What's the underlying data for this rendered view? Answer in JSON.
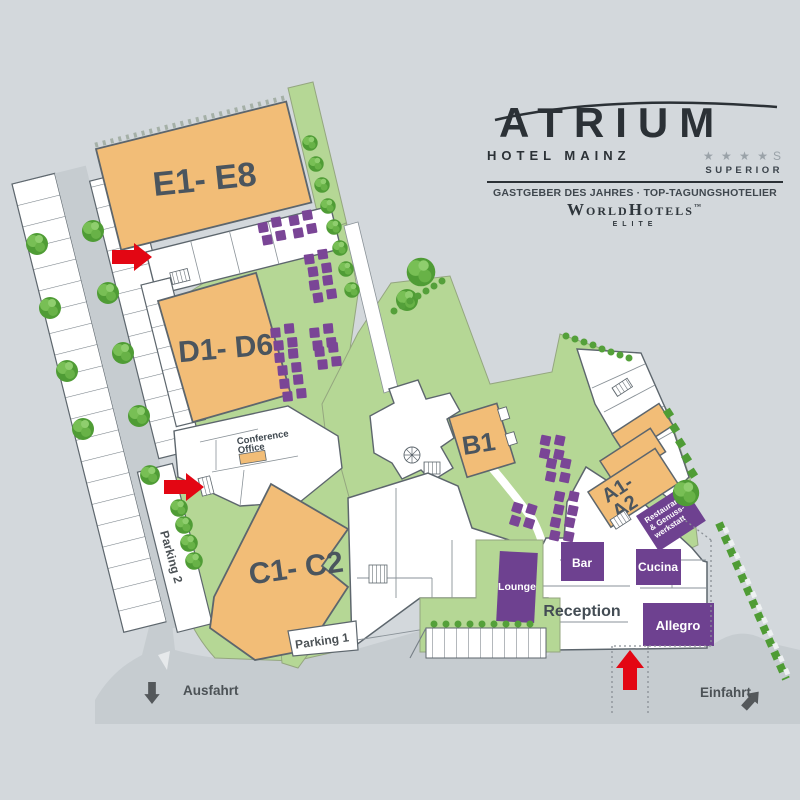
{
  "logo": {
    "brand": "ATRIUM",
    "subbrand": "HOTEL MAINZ",
    "stars": "★ ★ ★ ★",
    "stars_s": "S",
    "superior": "SUPERIOR",
    "award_line": "GASTGEBER DES JAHRES · TOP-TAGUNGSHOTELIER",
    "affiliation": "WorldHotels",
    "affiliation_tm": "™",
    "affiliation_tier": "ELITE"
  },
  "map": {
    "buildings": {
      "e": "E1- E8",
      "d": "D1- D6",
      "c": "C1- C2",
      "b": "B1",
      "a1": "A1-",
      "a2": "A2"
    },
    "venues": {
      "lounge": "Lounge",
      "bar": "Bar",
      "cucina": "Cucina",
      "restaurant1": "Restaurant",
      "restaurant2": "& Genuss-",
      "restaurant3": "werkstatt",
      "reception": "Reception",
      "allegro": "Allegro",
      "conference1": "Conference",
      "conference2": "Office"
    },
    "parking": {
      "p1": "Parking 1",
      "p2": "Parking 2"
    },
    "directions": {
      "exit": "Ausfahrt",
      "entrance": "Einfahrt"
    }
  },
  "colors": {
    "background": "#d3d8dc",
    "road": "#c6ccd0",
    "lawn": "#b5d795",
    "building_orange": "#f2bd77",
    "room_purple": "#6e4190",
    "table_purple": "#7a4596",
    "tree_green": "#4f9c35",
    "accent_red": "#e30613",
    "text_dark": "#49525a"
  }
}
